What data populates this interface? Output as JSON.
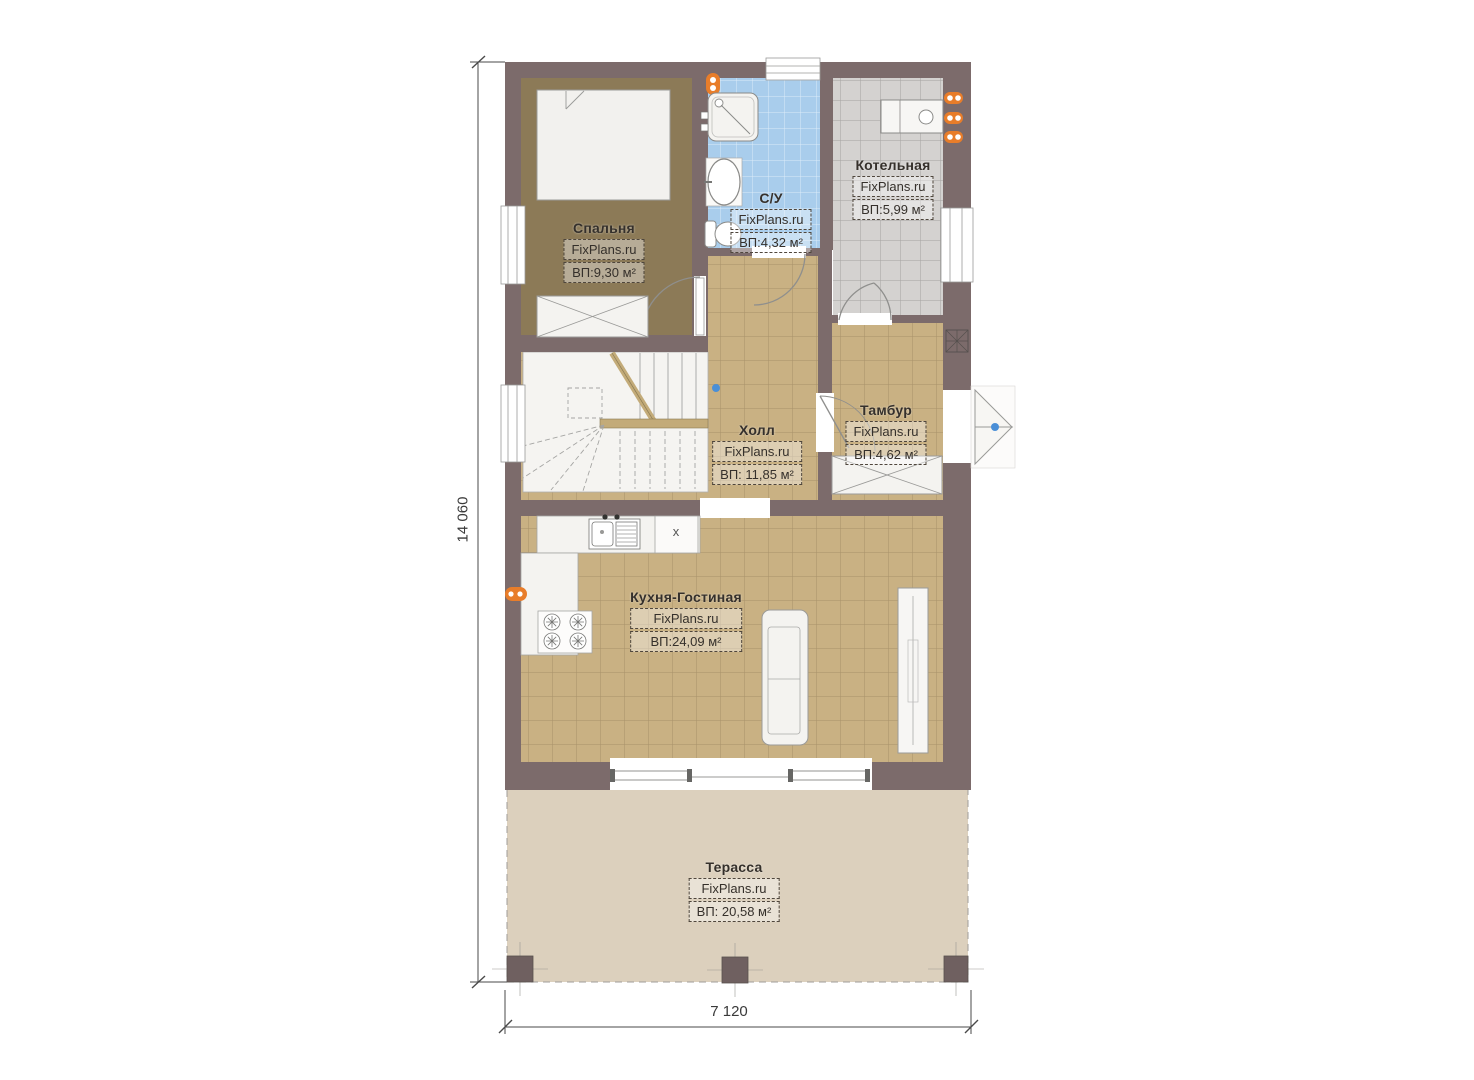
{
  "page": {
    "background": "#ffffff"
  },
  "plan": {
    "brand": "FixPlans.ru",
    "rooms": [
      {
        "name": "Спальня",
        "brand": "FixPlans.ru",
        "area": "ВП:9,30 м²"
      },
      {
        "name": "С/У",
        "brand": "FixPlans.ru",
        "area": "ВП:4,32 м²"
      },
      {
        "name": "Котельная",
        "brand": "FixPlans.ru",
        "area": "ВП:5,99 м²"
      },
      {
        "name": "Тамбур",
        "brand": "FixPlans.ru",
        "area": "ВП:4,62 м²"
      },
      {
        "name": "Холл",
        "brand": "FixPlans.ru",
        "area": "ВП: 11,85 м²"
      },
      {
        "name": "Кухня-Гостиная",
        "brand": "FixPlans.ru",
        "area": "ВП:24,09 м²"
      },
      {
        "name": "Терасса",
        "brand": "FixPlans.ru",
        "area": "ВП: 20,58 м²"
      }
    ],
    "dimensions": {
      "total_height_mm": "14 060",
      "total_width_mm": "7 120"
    },
    "annotations": {
      "kitchen_appliance_mark": "x"
    },
    "colors": {
      "wall": "#7c6b6b",
      "bedroom_floor": "#8c7a57",
      "tile_tan": "#c9b183",
      "tile_blue": "#a9cdec",
      "tile_gray": "#d4d2d0",
      "terrace": "#dcd0bd",
      "accent_orange": "#e87d2a",
      "accent_blue": "#4a8fd7"
    }
  }
}
